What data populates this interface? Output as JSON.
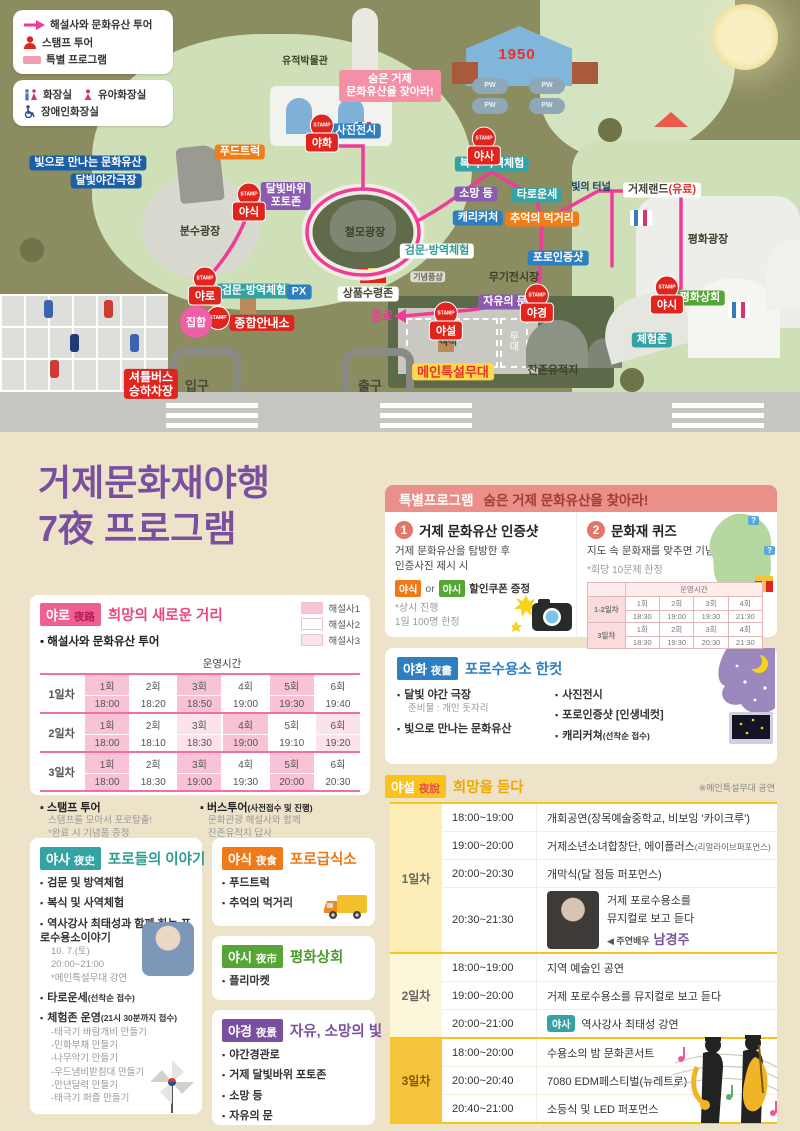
{
  "ui": {
    "bullet": "▪",
    "question_mark": "?"
  },
  "colors": {
    "pink": "#e8467e",
    "teal": "#35a3a3",
    "orange": "#f07a1a",
    "green": "#55a636",
    "purple": "#7b4fa0",
    "blue": "#2e7fc1",
    "yellow": "#fbc21c",
    "red": "#d93025",
    "route_pink": "#f23b97"
  },
  "map": {
    "stamp_word": "STAMP",
    "legend_tour": {
      "items": [
        {
          "icon": "arrow",
          "label": "해설사와 문화유산 투어"
        },
        {
          "icon": "person",
          "label": "스탬프 투어"
        },
        {
          "icon": "bar",
          "label": "특별 프로그램"
        }
      ]
    },
    "legend_facilities": {
      "items": [
        {
          "icon": "toilet",
          "label": "화장실"
        },
        {
          "icon": "baby",
          "label": "유아화장실"
        },
        {
          "icon": "wheelchair",
          "label": "장애인화장실"
        }
      ]
    },
    "labels": [
      {
        "text": "유적박물관",
        "x": 305,
        "y": 62,
        "type": "plain-sm"
      },
      {
        "text": "숨은 거제\n문화유산을 찾아라!",
        "x": 390,
        "y": 86,
        "type": "box-pink"
      },
      {
        "text": "사진전시",
        "x": 356,
        "y": 131,
        "type": "box-blue"
      },
      {
        "text": "1950",
        "x": 517,
        "y": 55,
        "type": "text-red"
      },
      {
        "text": "PW",
        "x": 490,
        "y": 86,
        "type": "pw"
      },
      {
        "text": "PW",
        "x": 490,
        "y": 106,
        "type": "pw"
      },
      {
        "text": "PW",
        "x": 547,
        "y": 86,
        "type": "pw"
      },
      {
        "text": "PW",
        "x": 547,
        "y": 106,
        "type": "pw"
      },
      {
        "text": "복식·사역체험",
        "x": 492,
        "y": 164,
        "type": "box-teal"
      },
      {
        "text": "소망 등",
        "x": 476,
        "y": 194,
        "type": "box-purple"
      },
      {
        "text": "타로운세",
        "x": 537,
        "y": 195,
        "type": "box-teal"
      },
      {
        "text": "캐리커처",
        "x": 478,
        "y": 218,
        "type": "box-blue"
      },
      {
        "text": "추억의 먹거리",
        "x": 542,
        "y": 219,
        "type": "box-orange"
      },
      {
        "text": "빛의 터널",
        "x": 591,
        "y": 188,
        "type": "plain-navy"
      },
      {
        "text": "거제랜드(유료)",
        "x": 662,
        "y": 190,
        "type": "box-white"
      },
      {
        "text": "평화광장",
        "x": 708,
        "y": 240,
        "type": "plain"
      },
      {
        "text": "평화상회",
        "x": 700,
        "y": 298,
        "type": "box-green"
      },
      {
        "text": "체험존",
        "x": 652,
        "y": 340,
        "type": "box-teal"
      },
      {
        "text": "푸드트럭",
        "x": 240,
        "y": 152,
        "type": "box-orange"
      },
      {
        "text": "빛으로 만나는 문화유산",
        "x": 88,
        "y": 163,
        "type": "box-navy"
      },
      {
        "text": "달빛야간극장",
        "x": 106,
        "y": 181,
        "type": "box-navy"
      },
      {
        "text": "달빛바위\n포토존",
        "x": 286,
        "y": 196,
        "type": "box-purple"
      },
      {
        "text": "분수광장",
        "x": 200,
        "y": 232,
        "type": "plain"
      },
      {
        "text": "검문·방역체험",
        "x": 254,
        "y": 291,
        "type": "box-teal"
      },
      {
        "text": "PX",
        "x": 299,
        "y": 292,
        "type": "box-blue"
      },
      {
        "text": "종합안내소",
        "x": 262,
        "y": 323,
        "type": "box-red"
      },
      {
        "text": "셔틀버스\n승하차장",
        "x": 151,
        "y": 384,
        "type": "box-red"
      },
      {
        "text": "입구",
        "x": 197,
        "y": 386,
        "type": "plain-big"
      },
      {
        "text": "출구",
        "x": 370,
        "y": 386,
        "type": "plain-big"
      },
      {
        "text": "철모광장",
        "x": 365,
        "y": 233,
        "type": "plain"
      },
      {
        "text": "검문·방역체험",
        "x": 437,
        "y": 251,
        "type": "box-teal-inv"
      },
      {
        "text": "기념품샵",
        "x": 428,
        "y": 277,
        "type": "small-gray"
      },
      {
        "text": "무기전시장",
        "x": 514,
        "y": 278,
        "type": "plain"
      },
      {
        "text": "포로인증샷",
        "x": 558,
        "y": 258,
        "type": "box-blue"
      },
      {
        "text": "자유의 문",
        "x": 505,
        "y": 302,
        "type": "box-purple"
      },
      {
        "text": "종료",
        "x": 382,
        "y": 316,
        "type": "text-pink"
      },
      {
        "text": "객석",
        "x": 448,
        "y": 343,
        "type": "plain-sm"
      },
      {
        "text": "무대",
        "x": 512,
        "y": 341,
        "type": "vert"
      },
      {
        "text": "메인특설무대",
        "x": 453,
        "y": 372,
        "type": "box-yellow"
      },
      {
        "text": "잔존유적지",
        "x": 553,
        "y": 371,
        "type": "plain"
      },
      {
        "text": "상품수령존",
        "x": 368,
        "y": 294,
        "type": "box-white"
      }
    ],
    "stamps": [
      {
        "label": "야화",
        "x": 322,
        "y": 133
      },
      {
        "label": "야사",
        "x": 484,
        "y": 146
      },
      {
        "label": "야식",
        "x": 249,
        "y": 202
      },
      {
        "label": "야로",
        "x": 205,
        "y": 286
      },
      {
        "label": "야시",
        "x": 667,
        "y": 295
      },
      {
        "label": "야경",
        "x": 537,
        "y": 303
      },
      {
        "label": "야설",
        "x": 446,
        "y": 321
      },
      {
        "label": "",
        "x": 218,
        "y": 318
      },
      {
        "label": "집합",
        "x": 196,
        "y": 322,
        "variant": "pink"
      }
    ]
  },
  "program": {
    "title": {
      "line1": "거제문화재야행",
      "line2": "7夜 프로그램"
    },
    "yaro": {
      "badge": "야로",
      "hanja": "夜路",
      "title": "희망의 새로운 거리",
      "legend": [
        {
          "label": "해설사1",
          "color": "#f8c3d6"
        },
        {
          "label": "해설사2",
          "color": "#ffffff"
        },
        {
          "label": "해설사3",
          "color": "#fbe2ec"
        }
      ],
      "subtitle": "해설사와 문화유산 투어",
      "table": {
        "time_header": "운영시간",
        "rows": [
          {
            "day": "1일차",
            "sessions": [
              {
                "n": "1회",
                "t": "18:00",
                "c": 1
              },
              {
                "n": "2회",
                "t": "18:20",
                "c": 2
              },
              {
                "n": "3회",
                "t": "18:50",
                "c": 1
              },
              {
                "n": "4회",
                "t": "19:00",
                "c": 2
              },
              {
                "n": "5회",
                "t": "19:30",
                "c": 1
              },
              {
                "n": "6회",
                "t": "19:40",
                "c": 2
              }
            ]
          },
          {
            "day": "2일차",
            "sessions": [
              {
                "n": "1회",
                "t": "18:00",
                "c": 1
              },
              {
                "n": "2회",
                "t": "18:10",
                "c": 2
              },
              {
                "n": "3회",
                "t": "18:30",
                "c": 3
              },
              {
                "n": "4회",
                "t": "19:00",
                "c": 1
              },
              {
                "n": "5회",
                "t": "19:10",
                "c": 2
              },
              {
                "n": "6회",
                "t": "19:20",
                "c": 3
              }
            ]
          },
          {
            "day": "3일차",
            "sessions": [
              {
                "n": "1회",
                "t": "18:00",
                "c": 1
              },
              {
                "n": "2회",
                "t": "18:30",
                "c": 2
              },
              {
                "n": "3회",
                "t": "19:00",
                "c": 1
              },
              {
                "n": "4회",
                "t": "19:30",
                "c": 2
              },
              {
                "n": "5회",
                "t": "20:00",
                "c": 1
              },
              {
                "n": "6회",
                "t": "20:30",
                "c": 2
              }
            ]
          }
        ]
      },
      "stamp_tour": {
        "title": "스탬프 투어",
        "lines": [
          "스탬프를 모아서 포로탈출!",
          "*완료 시 기념품 증정"
        ]
      },
      "bus_tour": {
        "title": "버스투어",
        "title_sub": "(사전접수 및 진행)",
        "lines": [
          "문화관광 해설사와 함께",
          "잔존유적지 답사"
        ]
      }
    },
    "special": {
      "header_badge": "특별프로그램",
      "header_title": "숨은 거제 문화유산을 찾아라!",
      "item1": {
        "num": "1",
        "title": "거제 문화유산 인증샷",
        "desc1": "거제 문화유산을 탐방한 후",
        "desc2": "인증사진 제시 시",
        "badge1": "야식",
        "or": "or",
        "badge2": "야시",
        "coupon": "할인쿠폰 증정",
        "note1": "*상시 진행",
        "note2": "1일 100명 한정"
      },
      "item2": {
        "num": "2",
        "title": "문화재 퀴즈",
        "desc": "지도 속 문화재를 맞추면 기념품 증정",
        "note": "*회당 10문제 한정",
        "table": {
          "time_header": "운영시간",
          "rows": [
            {
              "day": "1-2일차",
              "sessions": [
                {
                  "n": "1회",
                  "t": "18:30"
                },
                {
                  "n": "2회",
                  "t": "19:00"
                },
                {
                  "n": "3회",
                  "t": "19:30"
                },
                {
                  "n": "4회",
                  "t": "21:30"
                }
              ]
            },
            {
              "day": "3일차",
              "sessions": [
                {
                  "n": "1회",
                  "t": "18:30"
                },
                {
                  "n": "2회",
                  "t": "19:30"
                },
                {
                  "n": "3회",
                  "t": "20:30"
                },
                {
                  "n": "4회",
                  "t": "21:30"
                }
              ]
            }
          ]
        }
      }
    },
    "yahwa": {
      "badge": "야화",
      "hanja": "夜畵",
      "title": "포로수용소 한컷",
      "col1": [
        {
          "main": "달빛 야간 극장",
          "sub": "준비물 : 개인 돗자리"
        },
        {
          "main": "빛으로 만나는 문화유산"
        }
      ],
      "col2": [
        {
          "main": "사진전시"
        },
        {
          "main": "포로인증샷 [인생네컷]"
        },
        {
          "main": "캐리커쳐",
          "inline": "(선착순 접수)"
        }
      ]
    },
    "yasa": {
      "badge": "야사",
      "hanja": "夜史",
      "title": "포로들의 이야기",
      "bullets": [
        {
          "main": "검문 및 방역체험"
        },
        {
          "main": "복식 및 사역체험"
        },
        {
          "main": "역사강사 최태성과 함께 하는 포로수용소이야기",
          "subs": [
            "10. 7.(토)",
            "20:00~21:00",
            "*메인특설무대 강연"
          ]
        },
        {
          "main": "타로운세",
          "inline": "(선착순 접수)"
        },
        {
          "main": "체험존 운영",
          "inline": "(21시 30분까지 접수)",
          "subs": [
            "-태극기 바람개비 만들기",
            "-민화부채 만들기",
            "-나무악기 만들기",
            "-우드냄비받침대 만들기",
            "-만년달력 만들기",
            "-태극기 퍼즐 만들기"
          ]
        }
      ]
    },
    "yasik": {
      "badge": "야식",
      "hanja": "夜食",
      "title": "포로급식소",
      "bullets": [
        "푸드트럭",
        "추억의 먹거리"
      ]
    },
    "yasi": {
      "badge": "야시",
      "hanja": "夜市",
      "title": "평화상회",
      "bullets": [
        "플리마켓"
      ]
    },
    "yagyeong": {
      "badge": "야경",
      "hanja": "夜景",
      "title": "자유, 소망의 빛",
      "bullets": [
        "야간경관로",
        "거제 달빛바위 포토존",
        "소망 등",
        "자유의 문"
      ]
    },
    "yaseol": {
      "badge": "야설",
      "hanja": "夜說",
      "title": "희망을 듣다",
      "note": "※메인특설무대 공연",
      "days": [
        {
          "day": "1일차",
          "tone": "light",
          "rows": [
            {
              "time": "18:00~19:00",
              "desc": "개회공연(장목예술중학교, 비보잉 '카이크루')"
            },
            {
              "time": "19:00~20:00",
              "desc": "거제소년소녀합창단, 에이플러스",
              "desc_small": "(리얼라이브퍼포먼스)"
            },
            {
              "time": "20:00~20:30",
              "desc": "개막식(달 점등 퍼포먼스)"
            },
            {
              "time": "20:30~21:30",
              "desc": "거제 포로수용소를\n뮤지컬로 보고 듣다",
              "actor_prefix": "◀ 주연배우",
              "actor": "남경주",
              "photo": true
            }
          ]
        },
        {
          "day": "2일차",
          "tone": "pale",
          "rows": [
            {
              "time": "18:00~19:00",
              "desc": "지역 예술인 공연"
            },
            {
              "time": "19:00~20:00",
              "desc": "거제 포로수용소를 뮤지컬로 보고 듣다"
            },
            {
              "time": "20:00~21:00",
              "badge": "야사",
              "desc": "역사강사 최태성 강연"
            }
          ]
        },
        {
          "day": "3일차",
          "tone": "gold",
          "rows": [
            {
              "time": "18:00~20:00",
              "desc": "수용소의 밤 문화콘서트"
            },
            {
              "time": "20:00~20:40",
              "desc": "7080 EDM페스티벌(뉴레트로)"
            },
            {
              "time": "20:40~21:00",
              "desc": "소등식 및 LED 퍼포먼스"
            }
          ]
        }
      ]
    }
  }
}
